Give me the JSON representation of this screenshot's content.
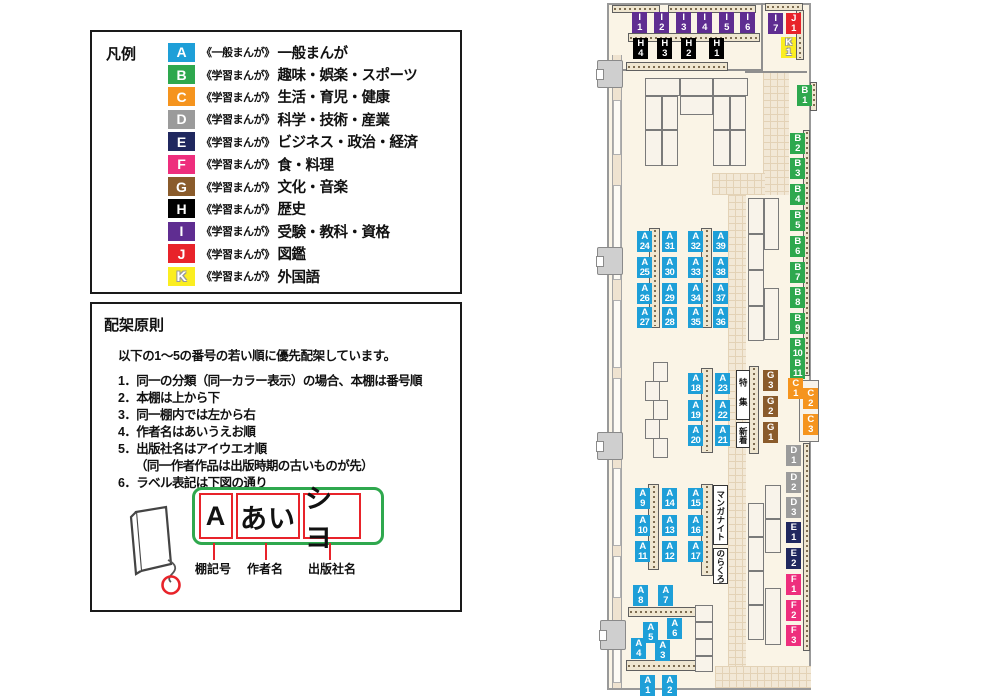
{
  "categories": {
    "A": "#1E9FD8",
    "B": "#2EA84E",
    "C": "#F5941E",
    "D": "#9B9B9B",
    "E": "#20285F",
    "F": "#EE2E7D",
    "G": "#8A5B2B",
    "H": "#000000",
    "I": "#5F2D91",
    "J": "#E8232A",
    "K": "#FBEE21"
  },
  "legend": {
    "title": "凡例",
    "items": [
      {
        "code": "A",
        "scope": "《一般まんが》",
        "label": "一般まんが"
      },
      {
        "code": "B",
        "scope": "《学習まんが》",
        "label": "趣味・娯楽・スポーツ"
      },
      {
        "code": "C",
        "scope": "《学習まんが》",
        "label": "生活・育児・健康"
      },
      {
        "code": "D",
        "scope": "《学習まんが》",
        "label": "科学・技術・産業"
      },
      {
        "code": "E",
        "scope": "《学習まんが》",
        "label": "ビジネス・政治・経済"
      },
      {
        "code": "F",
        "scope": "《学習まんが》",
        "label": "食・料理"
      },
      {
        "code": "G",
        "scope": "《学習まんが》",
        "label": "文化・音楽"
      },
      {
        "code": "H",
        "scope": "《学習まんが》",
        "label": "歴史"
      },
      {
        "code": "I",
        "scope": "《学習まんが》",
        "label": "受験・教科・資格"
      },
      {
        "code": "J",
        "scope": "《学習まんが》",
        "label": "図鑑"
      },
      {
        "code": "K",
        "scope": "《学習まんが》",
        "label": "外国語"
      }
    ]
  },
  "principles": {
    "title": "配架原則",
    "intro": "以下の1～5の番号の若い順に優先配架しています。",
    "rules": [
      {
        "text": "1．同一の分類（同一カラー表示）の場合、本棚は番号順",
        "indent": false
      },
      {
        "text": "2．本棚は上から下",
        "indent": false
      },
      {
        "text": "3．同一棚内では左から右",
        "indent": false
      },
      {
        "text": "4．作者名はあいうえお順",
        "indent": false
      },
      {
        "text": "5．出版社名はアイウエオ順",
        "indent": false
      },
      {
        "text": "（同一作者作品は出版時期の古いものが先）",
        "indent": true
      },
      {
        "text": "6．ラベル表記は下図の通り",
        "indent": false
      }
    ]
  },
  "label_diagram": {
    "segments": [
      {
        "text": "A",
        "caption": "棚記号"
      },
      {
        "text": "あい",
        "caption": "作者名"
      },
      {
        "text": "シヨ",
        "caption": "出版社名"
      }
    ]
  },
  "map": {
    "area_labels": {
      "feature": "特集",
      "new": "新着",
      "manga_night": "マンガナイト",
      "norakuro": "のらくろ"
    },
    "shelf_labels": [
      {
        "c": "I",
        "n": "1",
        "x": 37,
        "y": 12
      },
      {
        "c": "I",
        "n": "2",
        "x": 59,
        "y": 12
      },
      {
        "c": "I",
        "n": "3",
        "x": 81,
        "y": 12
      },
      {
        "c": "I",
        "n": "4",
        "x": 102,
        "y": 12
      },
      {
        "c": "I",
        "n": "5",
        "x": 124,
        "y": 12
      },
      {
        "c": "I",
        "n": "6",
        "x": 145,
        "y": 12
      },
      {
        "c": "I",
        "n": "7",
        "x": 173,
        "y": 13
      },
      {
        "c": "J",
        "n": "1",
        "x": 191,
        "y": 13
      },
      {
        "c": "K",
        "n": "1",
        "x": 186,
        "y": 37
      },
      {
        "c": "H",
        "n": "4",
        "x": 38,
        "y": 38
      },
      {
        "c": "H",
        "n": "3",
        "x": 62,
        "y": 38
      },
      {
        "c": "H",
        "n": "2",
        "x": 86,
        "y": 38
      },
      {
        "c": "H",
        "n": "1",
        "x": 114,
        "y": 38
      },
      {
        "c": "B",
        "n": "1",
        "x": 202,
        "y": 85
      },
      {
        "c": "B",
        "n": "2",
        "x": 195,
        "y": 133
      },
      {
        "c": "B",
        "n": "3",
        "x": 195,
        "y": 158
      },
      {
        "c": "B",
        "n": "4",
        "x": 195,
        "y": 184
      },
      {
        "c": "B",
        "n": "5",
        "x": 195,
        "y": 210
      },
      {
        "c": "B",
        "n": "6",
        "x": 195,
        "y": 236
      },
      {
        "c": "B",
        "n": "7",
        "x": 195,
        "y": 262
      },
      {
        "c": "B",
        "n": "8",
        "x": 195,
        "y": 287
      },
      {
        "c": "B",
        "n": "9",
        "x": 195,
        "y": 313
      },
      {
        "c": "B",
        "n": "10",
        "x": 195,
        "y": 338
      },
      {
        "c": "B",
        "n": "11",
        "x": 195,
        "y": 358
      },
      {
        "c": "C",
        "n": "1",
        "x": 193,
        "y": 378
      },
      {
        "c": "C",
        "n": "2",
        "x": 208,
        "y": 388
      },
      {
        "c": "C",
        "n": "3",
        "x": 208,
        "y": 414
      },
      {
        "c": "G",
        "n": "3",
        "x": 168,
        "y": 370
      },
      {
        "c": "G",
        "n": "2",
        "x": 168,
        "y": 396
      },
      {
        "c": "G",
        "n": "1",
        "x": 168,
        "y": 422
      },
      {
        "c": "D",
        "n": "1",
        "x": 191,
        "y": 445
      },
      {
        "c": "D",
        "n": "2",
        "x": 191,
        "y": 472
      },
      {
        "c": "D",
        "n": "3",
        "x": 191,
        "y": 497
      },
      {
        "c": "E",
        "n": "1",
        "x": 191,
        "y": 522
      },
      {
        "c": "E",
        "n": "2",
        "x": 191,
        "y": 548
      },
      {
        "c": "F",
        "n": "1",
        "x": 191,
        "y": 574
      },
      {
        "c": "F",
        "n": "2",
        "x": 191,
        "y": 600
      },
      {
        "c": "F",
        "n": "3",
        "x": 191,
        "y": 625
      },
      {
        "c": "A",
        "n": "24",
        "x": 42,
        "y": 231
      },
      {
        "c": "A",
        "n": "25",
        "x": 42,
        "y": 257
      },
      {
        "c": "A",
        "n": "26",
        "x": 42,
        "y": 283
      },
      {
        "c": "A",
        "n": "27",
        "x": 42,
        "y": 307
      },
      {
        "c": "A",
        "n": "31",
        "x": 67,
        "y": 231
      },
      {
        "c": "A",
        "n": "30",
        "x": 67,
        "y": 257
      },
      {
        "c": "A",
        "n": "29",
        "x": 67,
        "y": 283
      },
      {
        "c": "A",
        "n": "28",
        "x": 67,
        "y": 307
      },
      {
        "c": "A",
        "n": "32",
        "x": 93,
        "y": 231
      },
      {
        "c": "A",
        "n": "33",
        "x": 93,
        "y": 257
      },
      {
        "c": "A",
        "n": "34",
        "x": 93,
        "y": 283
      },
      {
        "c": "A",
        "n": "35",
        "x": 93,
        "y": 307
      },
      {
        "c": "A",
        "n": "39",
        "x": 118,
        "y": 231
      },
      {
        "c": "A",
        "n": "38",
        "x": 118,
        "y": 257
      },
      {
        "c": "A",
        "n": "37",
        "x": 118,
        "y": 283
      },
      {
        "c": "A",
        "n": "36",
        "x": 118,
        "y": 307
      },
      {
        "c": "A",
        "n": "18",
        "x": 93,
        "y": 373
      },
      {
        "c": "A",
        "n": "19",
        "x": 93,
        "y": 400
      },
      {
        "c": "A",
        "n": "20",
        "x": 93,
        "y": 425
      },
      {
        "c": "A",
        "n": "23",
        "x": 120,
        "y": 373
      },
      {
        "c": "A",
        "n": "22",
        "x": 120,
        "y": 400
      },
      {
        "c": "A",
        "n": "21",
        "x": 120,
        "y": 425
      },
      {
        "c": "A",
        "n": "9",
        "x": 40,
        "y": 488
      },
      {
        "c": "A",
        "n": "10",
        "x": 40,
        "y": 515
      },
      {
        "c": "A",
        "n": "11",
        "x": 40,
        "y": 541
      },
      {
        "c": "A",
        "n": "14",
        "x": 67,
        "y": 488
      },
      {
        "c": "A",
        "n": "13",
        "x": 67,
        "y": 515
      },
      {
        "c": "A",
        "n": "12",
        "x": 67,
        "y": 541
      },
      {
        "c": "A",
        "n": "15",
        "x": 93,
        "y": 488
      },
      {
        "c": "A",
        "n": "16",
        "x": 93,
        "y": 515
      },
      {
        "c": "A",
        "n": "17",
        "x": 93,
        "y": 541
      },
      {
        "c": "A",
        "n": "8",
        "x": 38,
        "y": 585
      },
      {
        "c": "A",
        "n": "7",
        "x": 63,
        "y": 585
      },
      {
        "c": "A",
        "n": "5",
        "x": 48,
        "y": 622
      },
      {
        "c": "A",
        "n": "6",
        "x": 72,
        "y": 618
      },
      {
        "c": "A",
        "n": "4",
        "x": 36,
        "y": 638
      },
      {
        "c": "A",
        "n": "3",
        "x": 60,
        "y": 640
      },
      {
        "c": "A",
        "n": "1",
        "x": 45,
        "y": 675
      },
      {
        "c": "A",
        "n": "2",
        "x": 67,
        "y": 675
      }
    ]
  }
}
